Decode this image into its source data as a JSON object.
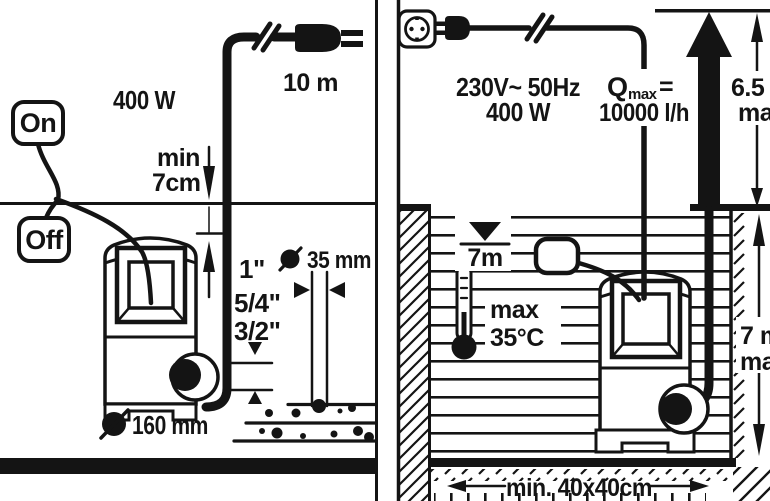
{
  "diagram": {
    "title": "Submersible pump installation pictogram",
    "ink": "#141414",
    "bg": "#ffffff"
  },
  "left_panel": {
    "power": "400 W",
    "cable_length": "10 m",
    "switch_on": "On",
    "switch_off": "Off",
    "min_immersion": [
      "min",
      "7cm"
    ],
    "hose_threads": [
      "1\"",
      "5/4\"",
      "3/2\""
    ],
    "max_particle_size": "35 mm",
    "pump_diameter": "160 mm"
  },
  "right_panel": {
    "voltage_frequency": "230V~ 50Hz",
    "power": "400 W",
    "qmax": {
      "q": "Q",
      "sub": "max",
      "eq": "=",
      "value": "10000 l/h"
    },
    "max_head": {
      "value": "6.5 m",
      "suffix": "max"
    },
    "max_immersion": "7m",
    "max_temp": [
      "max",
      "35°C"
    ],
    "pit_depth": {
      "value": "7 m",
      "suffix": "max"
    },
    "pit_size": "min. 40x40cm"
  }
}
